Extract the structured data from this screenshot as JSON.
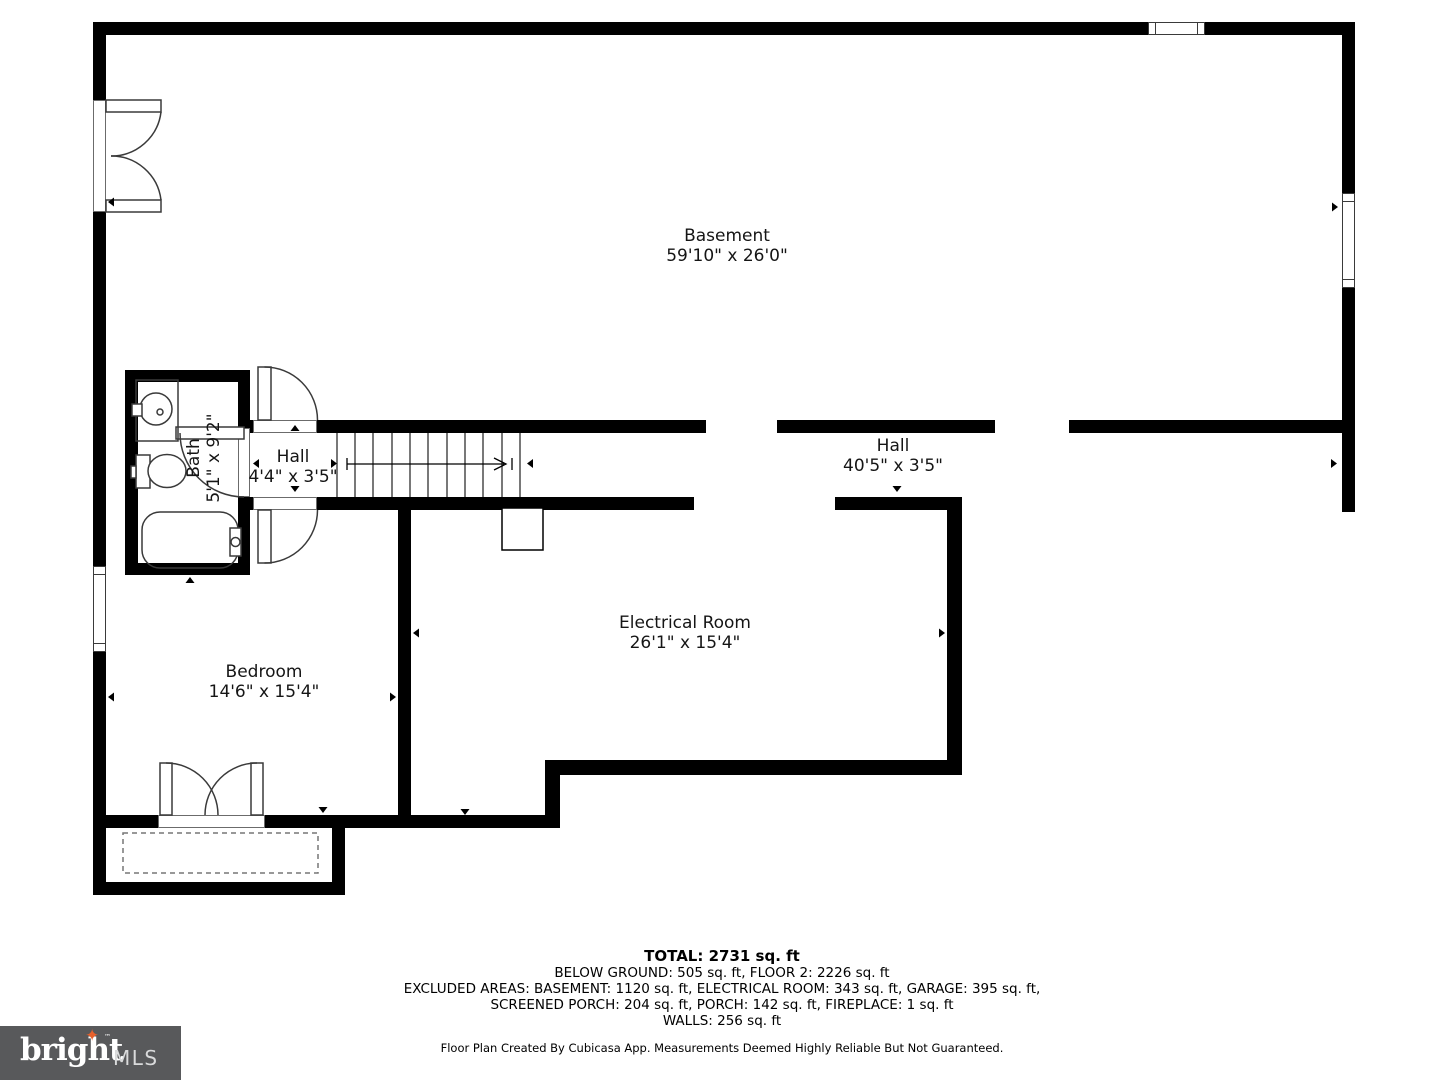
{
  "plan": {
    "rooms": {
      "basement": {
        "name": "Basement",
        "dims": "59'10\" x 26'0\""
      },
      "hall_main": {
        "name": "Hall",
        "dims": "40'5\" x 3'5\""
      },
      "hall_small": {
        "name": "Hall",
        "dims": "4'4\" x 3'5\""
      },
      "bath": {
        "name": "Bath",
        "dims": "5'1\" x 9'2\""
      },
      "bedroom": {
        "name": "Bedroom",
        "dims": "14'6\" x 15'4\""
      },
      "electrical_room": {
        "name": "Electrical Room",
        "dims": "26'1\" x 15'4\""
      }
    }
  },
  "summary": {
    "total": "TOTAL: 2731 sq. ft",
    "line1": "BELOW GROUND: 505 sq. ft, FLOOR 2: 2226 sq. ft",
    "line2": "EXCLUDED AREAS: BASEMENT: 1120 sq. ft, ELECTRICAL ROOM: 343 sq. ft, GARAGE: 395 sq. ft,",
    "line3": "SCREENED PORCH: 204 sq. ft, PORCH: 142 sq. ft, FIREPLACE: 1 sq. ft",
    "line4": "WALLS: 256 sq. ft",
    "disclaimer": "Floor Plan Created By Cubicasa App. Measurements Deemed Highly Reliable But Not Guaranteed."
  },
  "logo": {
    "brand": "bright",
    "star": "✦",
    "tm": "™",
    "suffix": "MLS",
    "background": "#58595b",
    "star_color": "#e8612c"
  },
  "colors": {
    "wall": "#000000",
    "thin_line": "#3a3a3a",
    "dashed_line": "#777777",
    "background": "#ffffff"
  }
}
